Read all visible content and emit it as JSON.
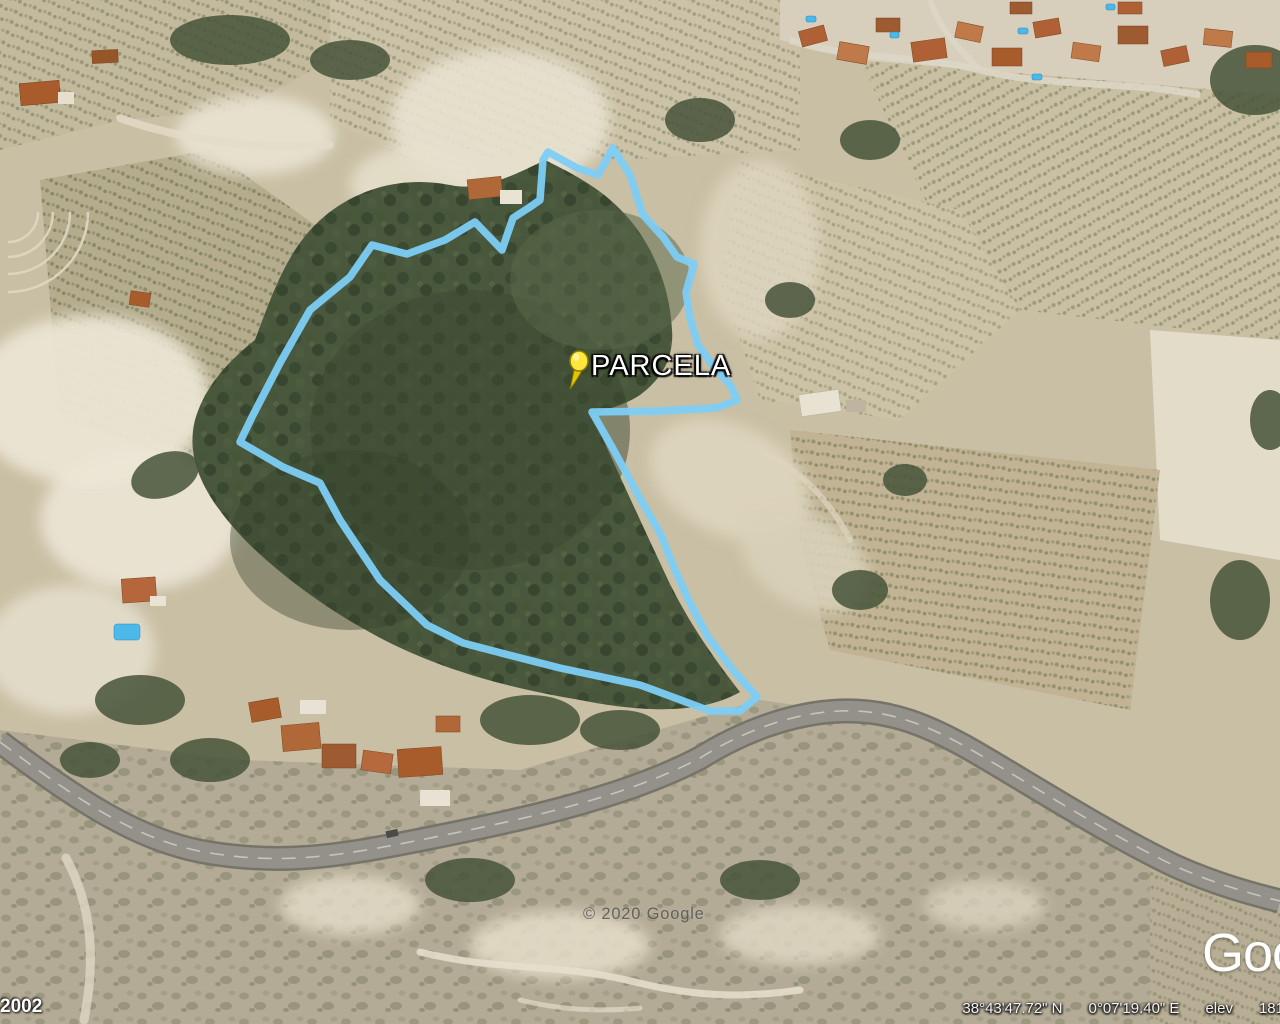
{
  "map": {
    "placemark_label": "PARCELA",
    "copyright_watermark": "© 2020 Google",
    "logo_text": "Google",
    "icons": {
      "placemark": "yellow-pushpin-icon"
    },
    "colors": {
      "parcel_outline": "#7dcdf5",
      "pushpin": "#ffe63c",
      "pool": "#4db8ea",
      "roof": "#a85c2c",
      "road": "#93918a"
    }
  },
  "status_bar": {
    "imagery_year": "2002",
    "latitude": "38°43'47.72\" N",
    "longitude": "0°07'19.40\" E",
    "elevation_label": "elev",
    "elevation_value": "181"
  }
}
